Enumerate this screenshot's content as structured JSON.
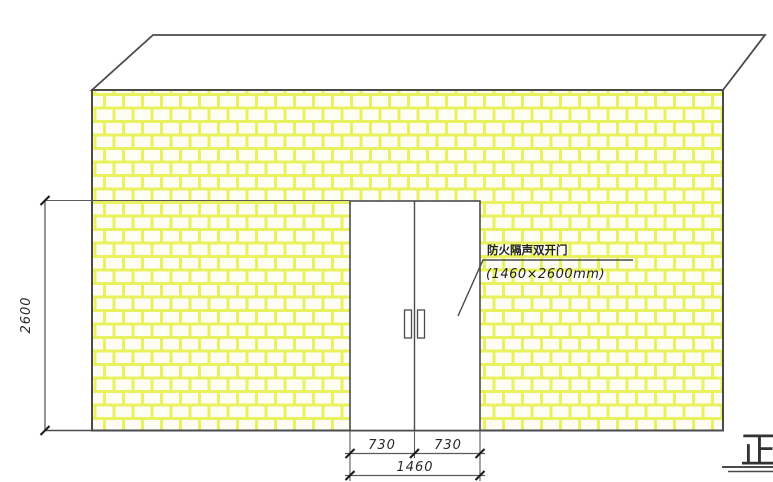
{
  "drawing": {
    "type": "wall-elevation-with-double-door",
    "annotation": {
      "line1": "防火隔声双开门",
      "line2": "(1460×2600mm)"
    },
    "dimensions": {
      "door_height": "2600",
      "left_leaf_width": "730",
      "right_leaf_width": "730",
      "door_total_width": "1460"
    },
    "title_fragment": "正",
    "colors": {
      "outline": "#4b4b4b",
      "brick_line": "#e9f15e",
      "brick_fill": "#fdfdf3",
      "dimension_line": "#5a5a5a",
      "text": "#2a2a2a"
    }
  }
}
